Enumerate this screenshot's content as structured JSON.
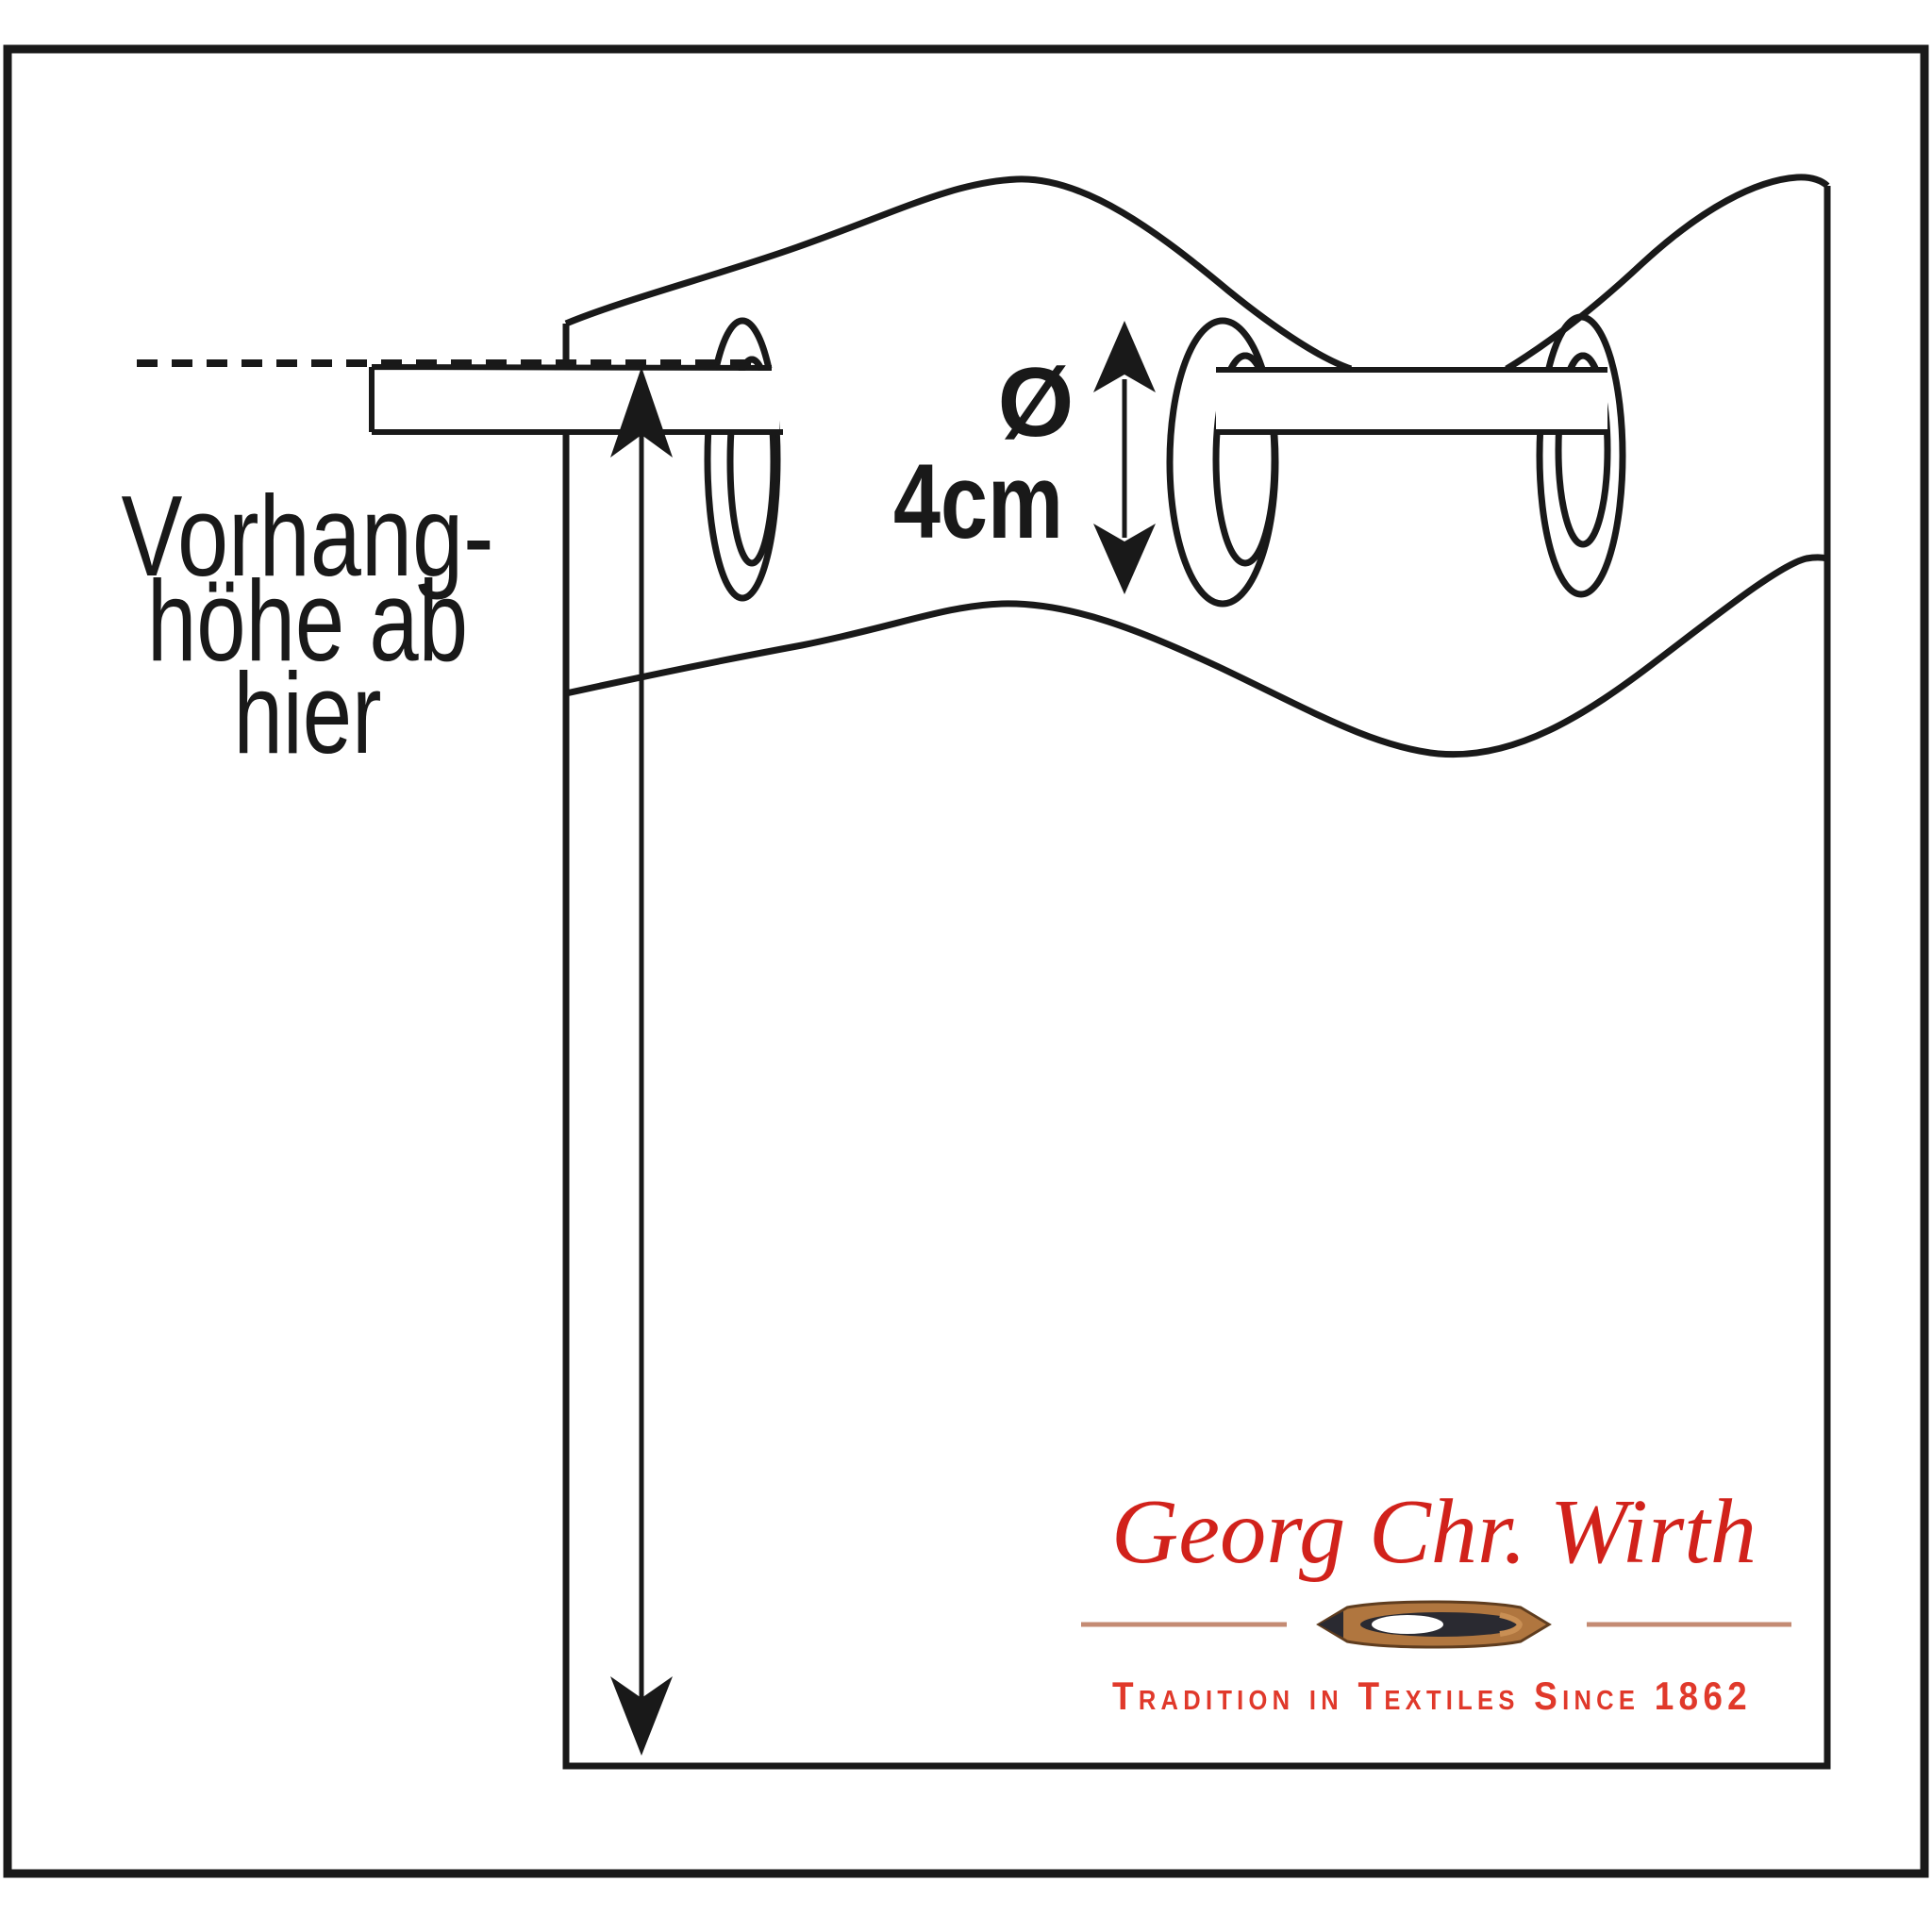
{
  "diagram": {
    "label": {
      "line1": "Vorhang-",
      "line2": "höhe ab",
      "line3": "hier"
    },
    "diameter": {
      "symbol": "Ø",
      "value": "4cm"
    }
  },
  "logo": {
    "name": "Georg Chr. Wirth",
    "tagline": "Tradition in Textiles Since 1862"
  },
  "colors": {
    "ink": "#191919",
    "logo_red": "#d1221b",
    "tagline_red": "#e0392b",
    "divider_rose": "#c48b73",
    "shuttle_wood": "#b0763f",
    "shuttle_dark": "#2a2a31",
    "background": "#ffffff"
  }
}
